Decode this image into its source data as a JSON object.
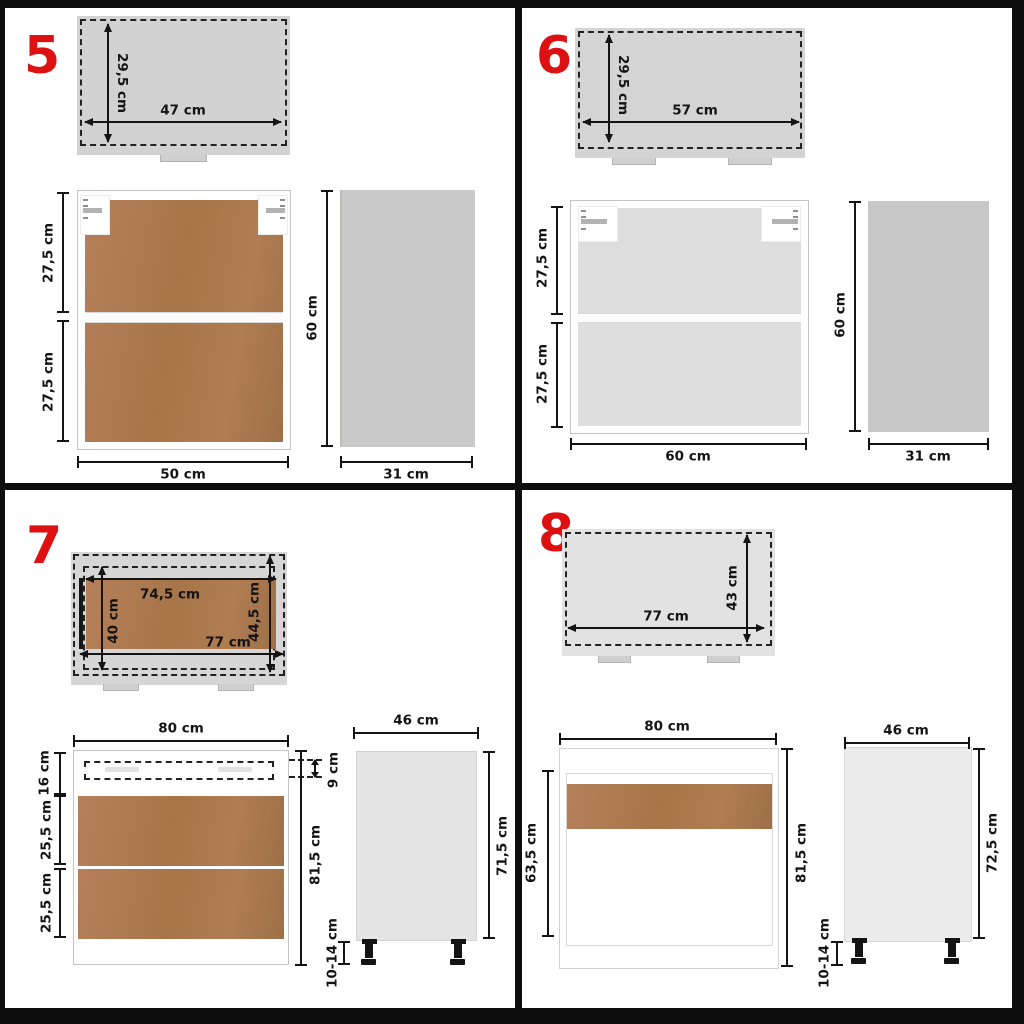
{
  "colors": {
    "accent_red": "#dd1111",
    "line": "#141414",
    "wood_brown": "#ab7951",
    "plan_gray": "#d3d3d3",
    "side_gray": "#c9c9c9"
  },
  "item5": {
    "label": "5",
    "top_depth": "29,5 cm",
    "top_width": "47 cm",
    "front_upper": "27,5 cm",
    "front_lower": "27,5 cm",
    "front_width": "50 cm",
    "side_height": "60 cm",
    "side_depth": "31 cm"
  },
  "item6": {
    "label": "6",
    "top_depth": "29,5 cm",
    "top_width": "57 cm",
    "front_upper": "27,5 cm",
    "front_lower": "27,5 cm",
    "front_width": "60 cm",
    "side_height": "60 cm",
    "side_depth": "31 cm"
  },
  "item7": {
    "label": "7",
    "top_inner_width": "74,5 cm",
    "top_inner_depth": "40 cm",
    "top_depth": "44,5 cm",
    "top_width": "77 cm",
    "front_width": "80 cm",
    "drawer_front": "16 cm",
    "drawer_inner": "9 cm",
    "shelf_upper": "25,5 cm",
    "shelf_lower": "25,5 cm",
    "front_height": "81,5 cm",
    "legs": "10-14 cm",
    "side_width": "46 cm",
    "side_height": "71,5 cm"
  },
  "item8": {
    "label": "8",
    "top_depth": "43 cm",
    "top_width": "77 cm",
    "front_width": "80 cm",
    "front_inner_height": "63,5 cm",
    "front_height": "81,5 cm",
    "legs": "10-14 cm",
    "side_width": "46 cm",
    "side_height": "72,5 cm"
  }
}
